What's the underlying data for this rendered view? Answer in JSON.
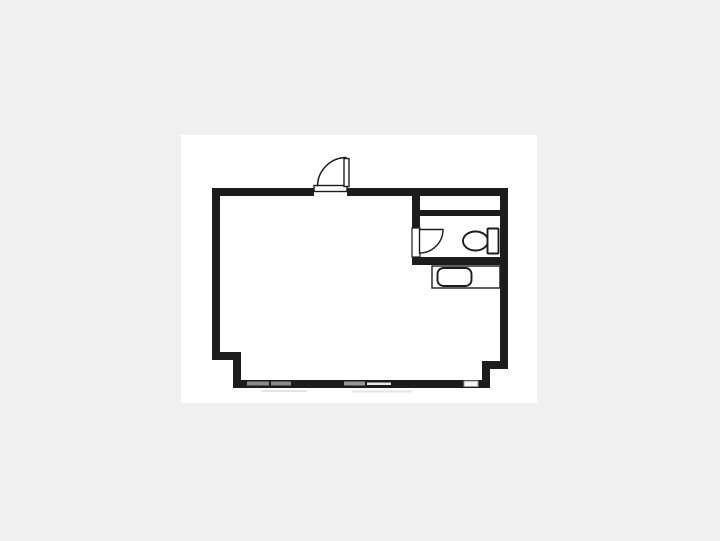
{
  "colors": {
    "bg": "#f0f0f0",
    "paper": "#ffffff",
    "wall": "#1c1c1c",
    "window-gray": "#8a8a8a"
  },
  "floorplan": {
    "kind": "floor-plan-drawing",
    "rooms": [
      {
        "name": "main-room",
        "note": "large open room, unlabeled"
      },
      {
        "name": "toilet-room",
        "note": "small room upper right with toilet"
      },
      {
        "name": "upper-right-compartment",
        "note": "narrow strip between top wall and toilet room"
      }
    ],
    "fixtures": [
      {
        "name": "entrance-door",
        "type": "swing-door",
        "swing": "outward-left",
        "location": "top-wall-opening"
      },
      {
        "name": "toilet-door",
        "type": "swing-door",
        "swing": "inward",
        "location": "toilet-room-left-wall"
      },
      {
        "name": "toilet",
        "type": "toilet-bowl-with-tank",
        "facing": "left",
        "location": "toilet-room"
      },
      {
        "name": "washbasin-counter",
        "type": "counter-with-sink",
        "location": "below-toilet-room"
      }
    ],
    "window_segments": 5
  }
}
